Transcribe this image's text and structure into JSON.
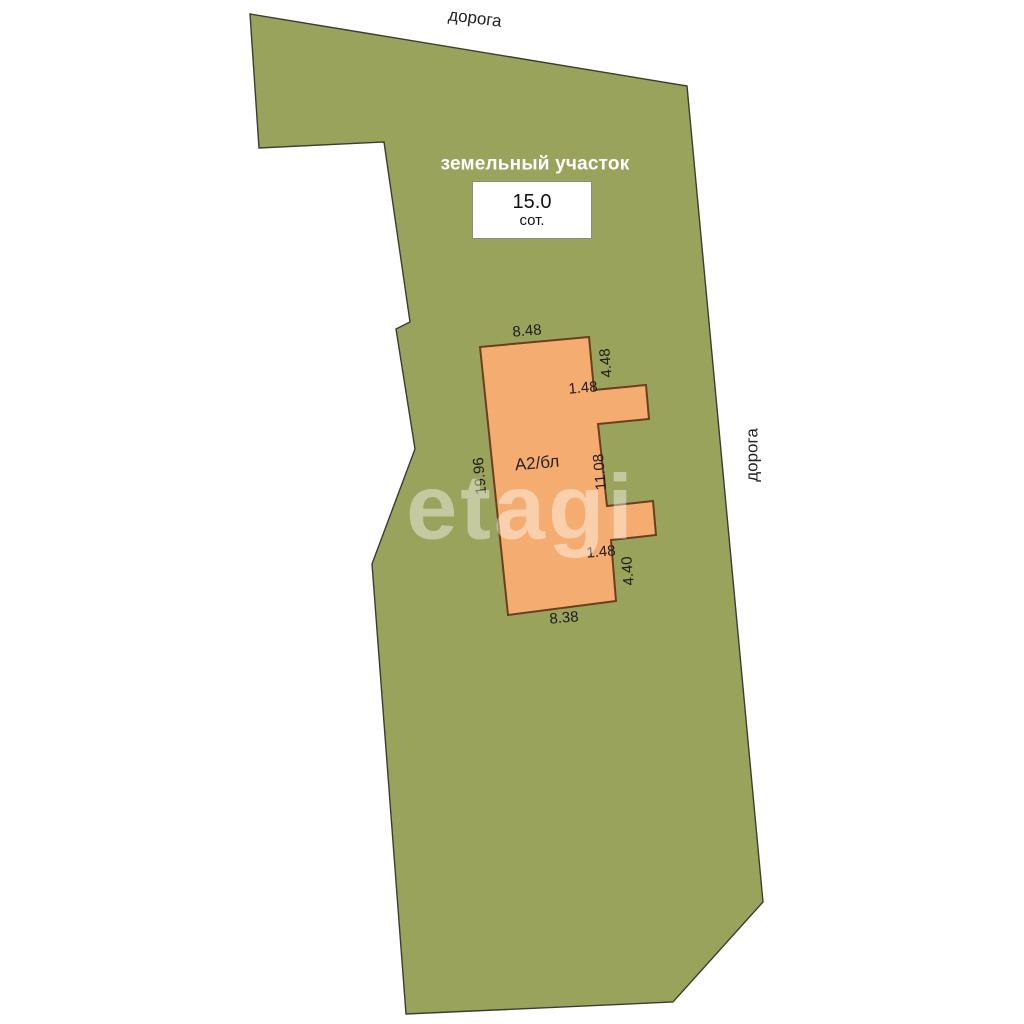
{
  "plan": {
    "road_top": "дорога",
    "road_right": "дорога",
    "plot": {
      "title": "земельный участок",
      "area_value": "15.0",
      "area_unit": "сот."
    },
    "building": {
      "label": "А2/бл",
      "dim_top": "8.48",
      "dim_right_upper": "4.48",
      "dim_notch_top": "1.48",
      "dim_right_middle": "11.08",
      "dim_notch_bottom": "1.48",
      "dim_right_lower": "4.40",
      "dim_bottom": "8.38",
      "dim_left": "19.96"
    },
    "watermark": "etagi",
    "colors": {
      "plot_fill": "#9aa35c",
      "building_fill": "#f5ac70"
    }
  }
}
